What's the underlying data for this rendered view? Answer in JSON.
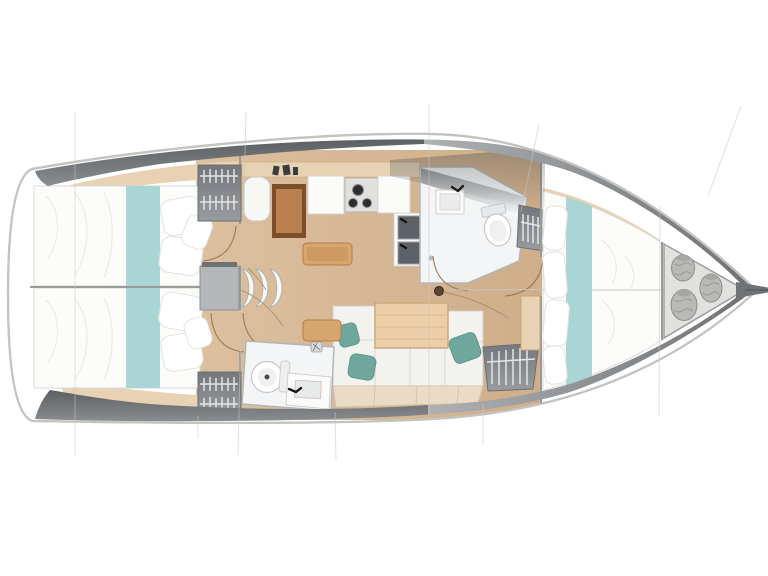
{
  "image": {
    "kind": "sailboat interior deck plan, plan view, bow pointing right",
    "width": 768,
    "height": 576,
    "background": "#ffffff"
  },
  "colors": {
    "hull_outline": "#c3c3c1",
    "deck_dark": "#606366",
    "deck_mid": "#86898c",
    "deck_bow": "#8f9396",
    "floor_wood": "#d7b996",
    "shelf_wood": "#e7d2b4",
    "shelf_edge": "#c9a87f",
    "chart_table_dark": "#7c4f28",
    "chart_table_light": "#bb8050",
    "sideboard": "#d7a66e",
    "sideboard_edge": "#b07e48",
    "table_wood": "#eccfa8",
    "table_edge": "#cda87c",
    "teal_bedding": "#a9d6d5",
    "teal_pillow": "#6fa79c",
    "mattress": "#fcfcfb",
    "pillow": "#ffffff",
    "cushion": "#f2f2ef",
    "cushion_base": "#eadbc6",
    "locker": "#7d8286",
    "hanger": "#e3e4e5",
    "room": "#f4f5f6",
    "white_counter": "#fbfbfa",
    "stove_panel": "#e0e0de",
    "burner": "#2e2e2e",
    "sink_steel": "#5d6267",
    "sink_rim": "#9aa0a5",
    "fixture_white": "#ffffff",
    "fender": "#b9b9b7",
    "bow_locker": "#e1e1e0",
    "bow_locker_edge": "#9d9d9b",
    "section_line": "#c6c6c4",
    "door_arc": "#9b7a57",
    "mast": "#5b4632",
    "step": "#f7f7f5",
    "platform": "#b4b7ba",
    "hatch_dark": "#6f7274",
    "bowsprit": "#707376",
    "instrument": "#3c3c3c"
  },
  "components": {
    "hull": "hull outline with side decks",
    "aft_cabin_port": "aft double berth cabin (top left) with teal runner and pillows",
    "aft_cabin_starboard": "aft double berth cabin (bottom left) with teal runner and pillows",
    "hanging_lockers": "four wardrobe lockers with clothes hangers",
    "companionway": "companionway steps between aft cabins",
    "nav_station": "chart table with seat",
    "galley": "L-shaped galley with stove, double sink and counters",
    "head_forward": "forward bathroom with toilet, sink and shower",
    "head_aft": "aft bathroom with toilet and vanity sink",
    "salon": "salon settee with table and teal cushions",
    "mast": "mast foot on centerline",
    "forward_cabin": "V-berth owner cabin with teal runner",
    "bow_locker": "bow sail locker with three fenders",
    "bowsprit": "bowsprit at bow tip"
  }
}
